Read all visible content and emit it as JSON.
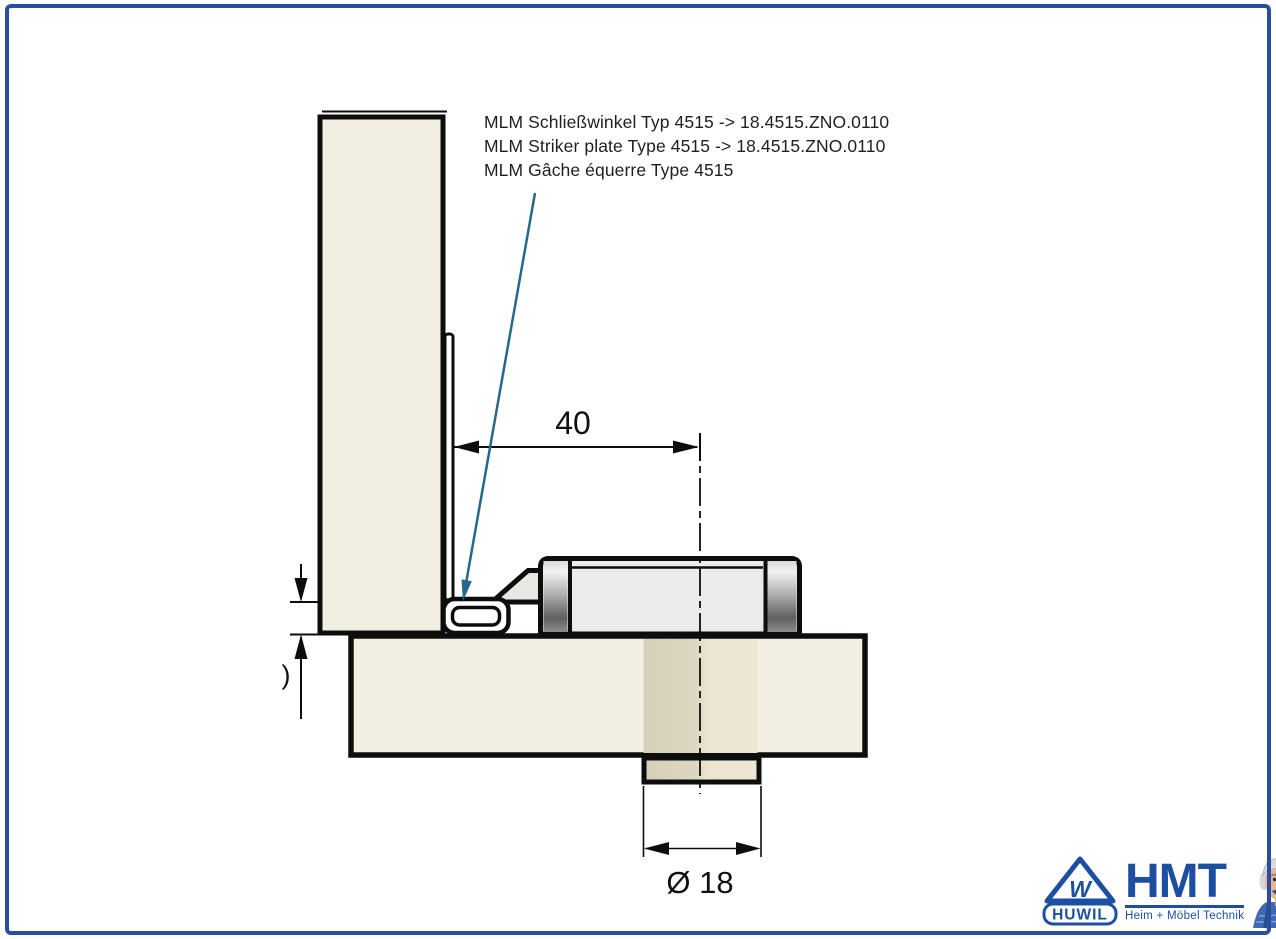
{
  "annotation": {
    "lines": [
      "MLM Schließwinkel Typ 4515 -> 18.4515.ZNO.0110",
      "MLM Striker plate Type 4515 -> 18.4515.ZNO.0110",
      "MLM Gâche équerre Type 4515"
    ]
  },
  "dimensions": {
    "horizontal": "40",
    "diameter": "Ø 18",
    "left_partial": ")"
  },
  "logo": {
    "huwil_w": "W",
    "huwil": "HUWIL",
    "hmt": "HMT",
    "tagline": "Heim + Möbel Technik"
  },
  "colors": {
    "border_blue": "#2c4c9c",
    "logo_blue": "#1d4fa0",
    "leader_blue": "#26688a",
    "panel_fill": "#f2efe2",
    "through_hole_beige": "#ddd7c1",
    "lock_body_grey": "#eaecec",
    "line_black": "#0d0d0d"
  }
}
